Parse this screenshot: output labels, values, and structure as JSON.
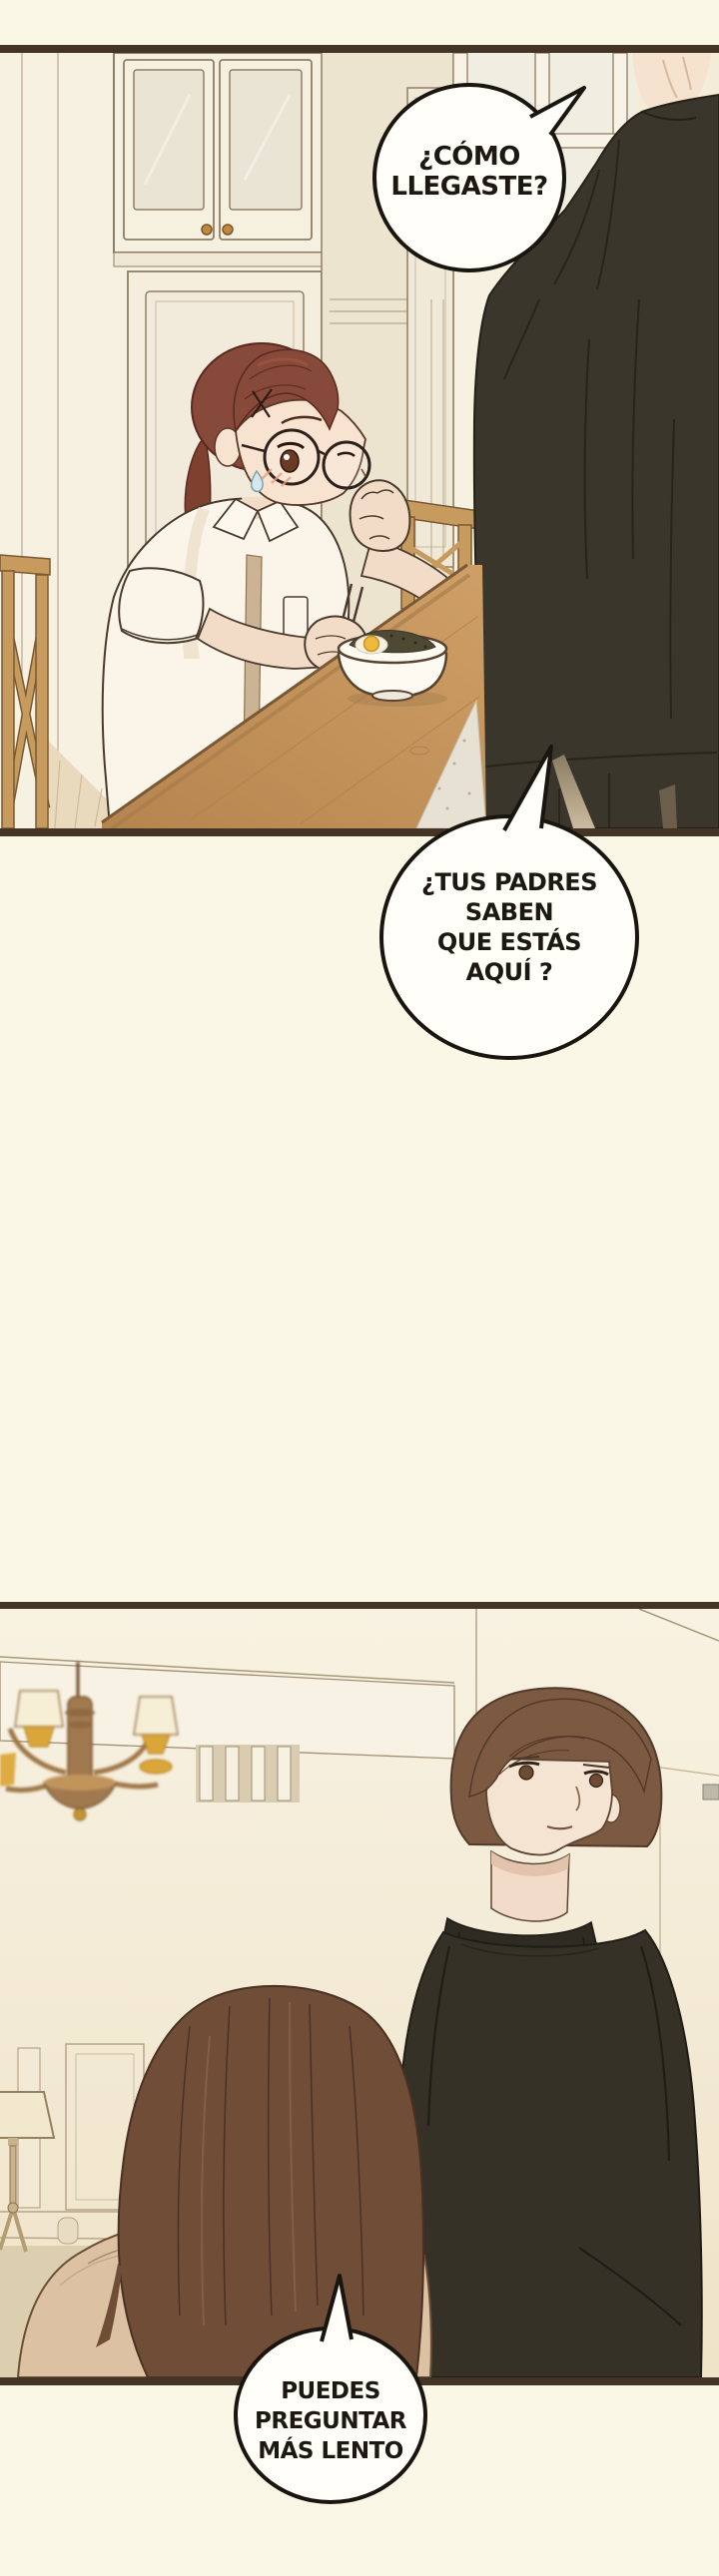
{
  "page": {
    "background_color": "#FBF7E6",
    "panel_border_color": "#443425",
    "bubble_fill": "#FFFEF8",
    "bubble_outline": "#1A150F",
    "text_color": "#1E1812"
  },
  "speech_bubbles": [
    {
      "id": "bubble-1",
      "lines": [
        "¿CÓMO",
        "LLEGASTE?"
      ]
    },
    {
      "id": "bubble-2",
      "lines": [
        "¿TUS PADRES",
        "SABEN",
        "QUE ESTÁS",
        "AQUÍ ?"
      ]
    },
    {
      "id": "bubble-3",
      "lines": [
        "PUEDES",
        "PREGUNTAR",
        "MÁS LENTO"
      ]
    }
  ],
  "palette": {
    "wall_cream": "#F7F1E2",
    "wood_table": "#C89A60",
    "chair_wood": "#C79B5E",
    "man_jacket": "#3A362B",
    "man_sweater": "#353127",
    "girl_hair": "#87493A",
    "girl_shirt": "#FBF5E9",
    "man_hair": "#7B5A41",
    "woman_hair": "#6F4D37",
    "woman_coat": "#DCC2A2",
    "chandelier_gold": "#DBA639",
    "skin": "#F6E4D2"
  }
}
